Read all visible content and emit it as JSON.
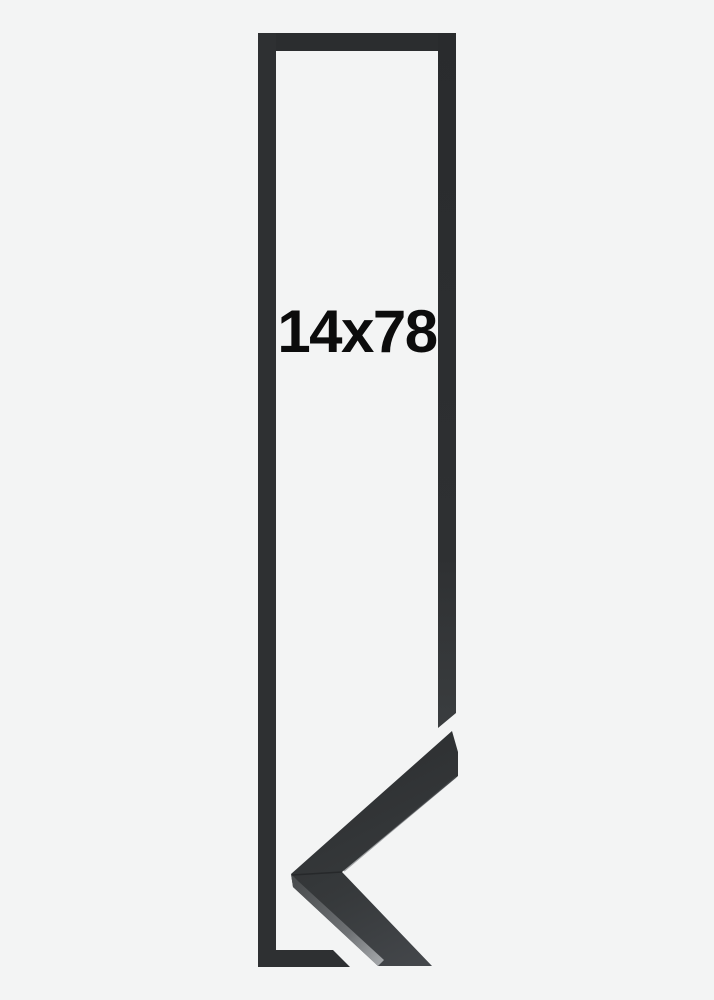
{
  "image": {
    "width": 714,
    "height": 1000,
    "description_role": "product-frame-size-illustration"
  },
  "product": {
    "dimension_label": "14x78"
  },
  "colors": {
    "bg": "#f3f4f4",
    "text": "#0c0c0c",
    "outline": "#2d2f31",
    "outline-top": "#292b2d",
    "outline-bottom": "#3a3d3f",
    "sample-face-dark": "#2c2e30",
    "sample-face-light": "#45484c",
    "bevel-dark": "#4b4e50",
    "bevel-light": "#a7aaad",
    "seam": "#232527"
  }
}
